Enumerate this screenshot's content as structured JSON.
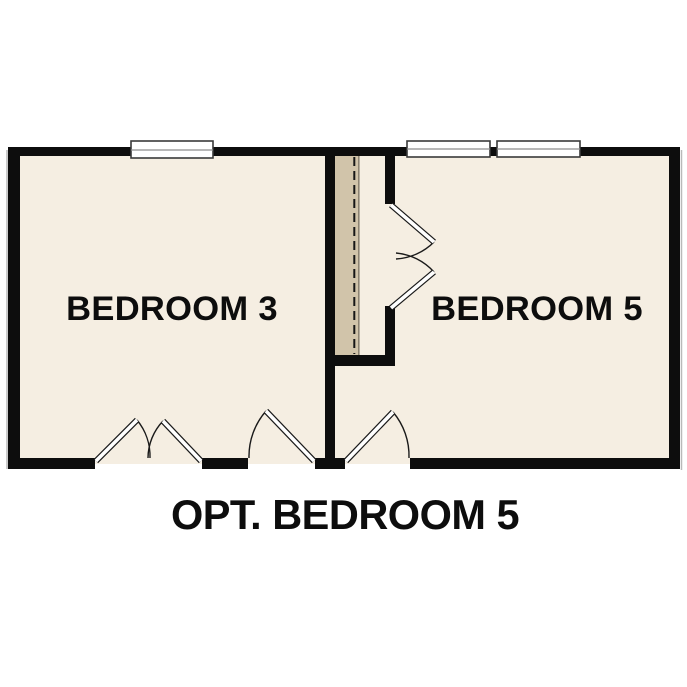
{
  "plan": {
    "caption": "OPT. BEDROOM 5",
    "rooms": [
      {
        "id": "bedroom-3",
        "label": "BEDROOM 3"
      },
      {
        "id": "bedroom-5",
        "label": "BEDROOM 5"
      }
    ],
    "symbols": {
      "windows": [
        "bedroom-3-window",
        "bedroom-5-window-left",
        "bedroom-5-window-right"
      ],
      "doors": [
        "bedroom-3-double-door",
        "bedroom-3-entry-door",
        "bedroom-5-entry-door",
        "closet-double-door"
      ],
      "optional_wall_marker": "dashed-line-in-closet"
    },
    "colors": {
      "wall": "#0d0d0d",
      "floor": "#f5eee2",
      "closet": "#d1c4aa",
      "background": "#ffffff",
      "text": "#0d0d0d"
    }
  }
}
